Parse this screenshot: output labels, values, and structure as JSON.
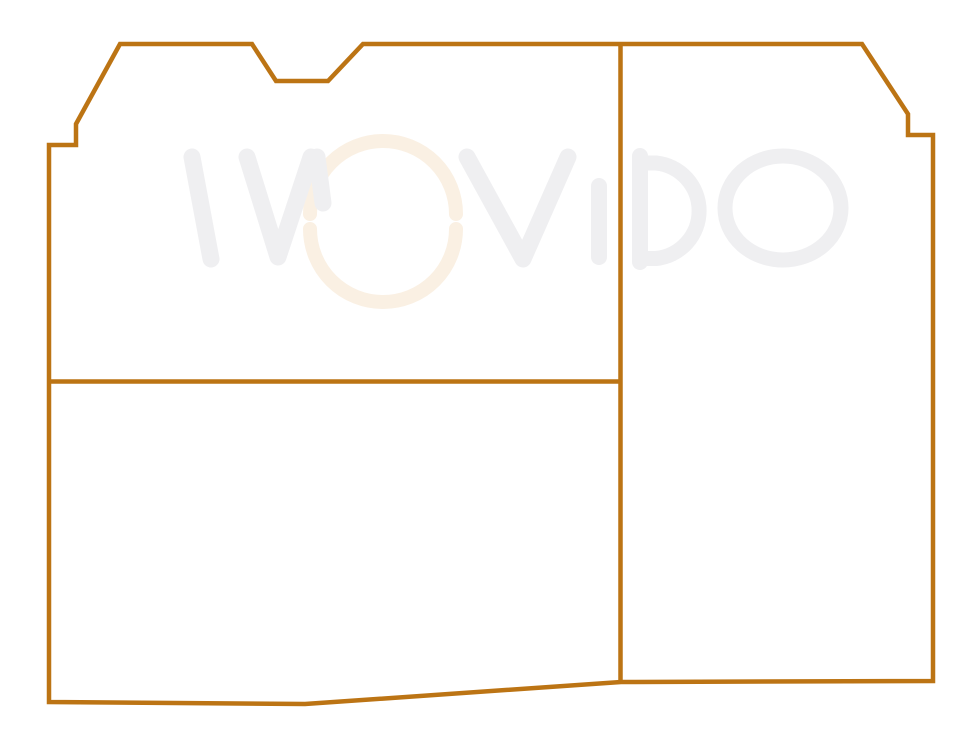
{
  "canvas": {
    "background_color": "#ffffff"
  },
  "drawing": {
    "line_color": "#bc7414",
    "outline_path": "M49,145 L76,145 L76,124 L120,44 L252,44 L276,81 L328,81 L363,44 L862,44 L908,114 L908,135 L933,135 L933,681 L621,682 L305,704 L49,702 Z",
    "vertical_divider_path": "M620.5,44 L620.5,681",
    "horizontal_divider_path": "M49,381.5 L620.5,381.5"
  },
  "watermark": {
    "text": "WOViDO",
    "letter_color": "#efeff1",
    "accent_color": "#faf0e3",
    "glyphs": {
      "w_stem": "M192,157 L211,259",
      "w_vee": "M247,157 L278,257 L311,157",
      "w_tail": "M317,157 L323,203",
      "o_arc_top": "M310,214 A73,73 0 0 1 456,214",
      "o_arc_bottom": "M310,229 A73,73 0 0 0 456,229",
      "v": "M467,157 L523,259 L568,157",
      "i": "M599,186 L599,257",
      "d_stem": "M640,156 L640,262",
      "d_bowl": "M640,163 L656,163 A48,48 0 0 1 656,258.5 L640,258.5",
      "o2": "M725,208 A58,52 0 1 1 841,208 A58,52 0 1 1 725,208"
    }
  }
}
